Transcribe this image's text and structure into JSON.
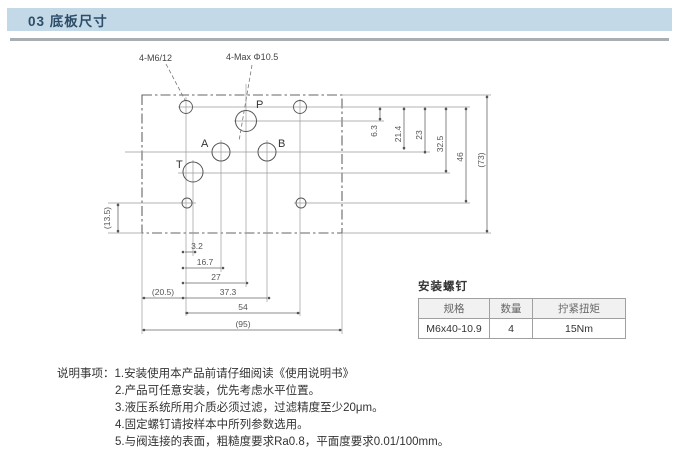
{
  "page": {
    "header": "03 底板尺寸"
  },
  "drawing": {
    "callouts": {
      "thread": "4-M6/12",
      "ports_max": "4-Max Φ10.5"
    },
    "port_labels": {
      "p": "P",
      "a": "A",
      "b": "B",
      "t": "T"
    },
    "dims_bottom": [
      "3.2",
      "16.7",
      "27",
      "(20.5)",
      "37.3",
      "54",
      "(95)"
    ],
    "dims_right": [
      "6.3",
      "21.4",
      "23",
      "32.5",
      "46",
      "(73)"
    ],
    "dim_left": "(13.5)"
  },
  "screw_table": {
    "title": "安装螺钉",
    "headers": [
      "规格",
      "数量",
      "拧紧扭矩"
    ],
    "rows": [
      [
        "M6x40-10.9",
        "4",
        "15Nm"
      ]
    ]
  },
  "notes": {
    "label": "说明事项：",
    "items": [
      "1.安装使用本产品前请仔细阅读《使用说明书》",
      "2.产品可任意安装，优先考虑水平位置。",
      "3.液压系统所用介质必须过滤，过滤精度至少20μm。",
      "4.固定螺钉请按样本中所列参数选用。",
      "5.与阀连接的表面，粗糙度要求Ra0.8，平面度要求0.01/100mm。"
    ]
  },
  "colors": {
    "header_bg": "#c4d9e7",
    "header_text": "#2c4d68",
    "line": "#777777"
  }
}
